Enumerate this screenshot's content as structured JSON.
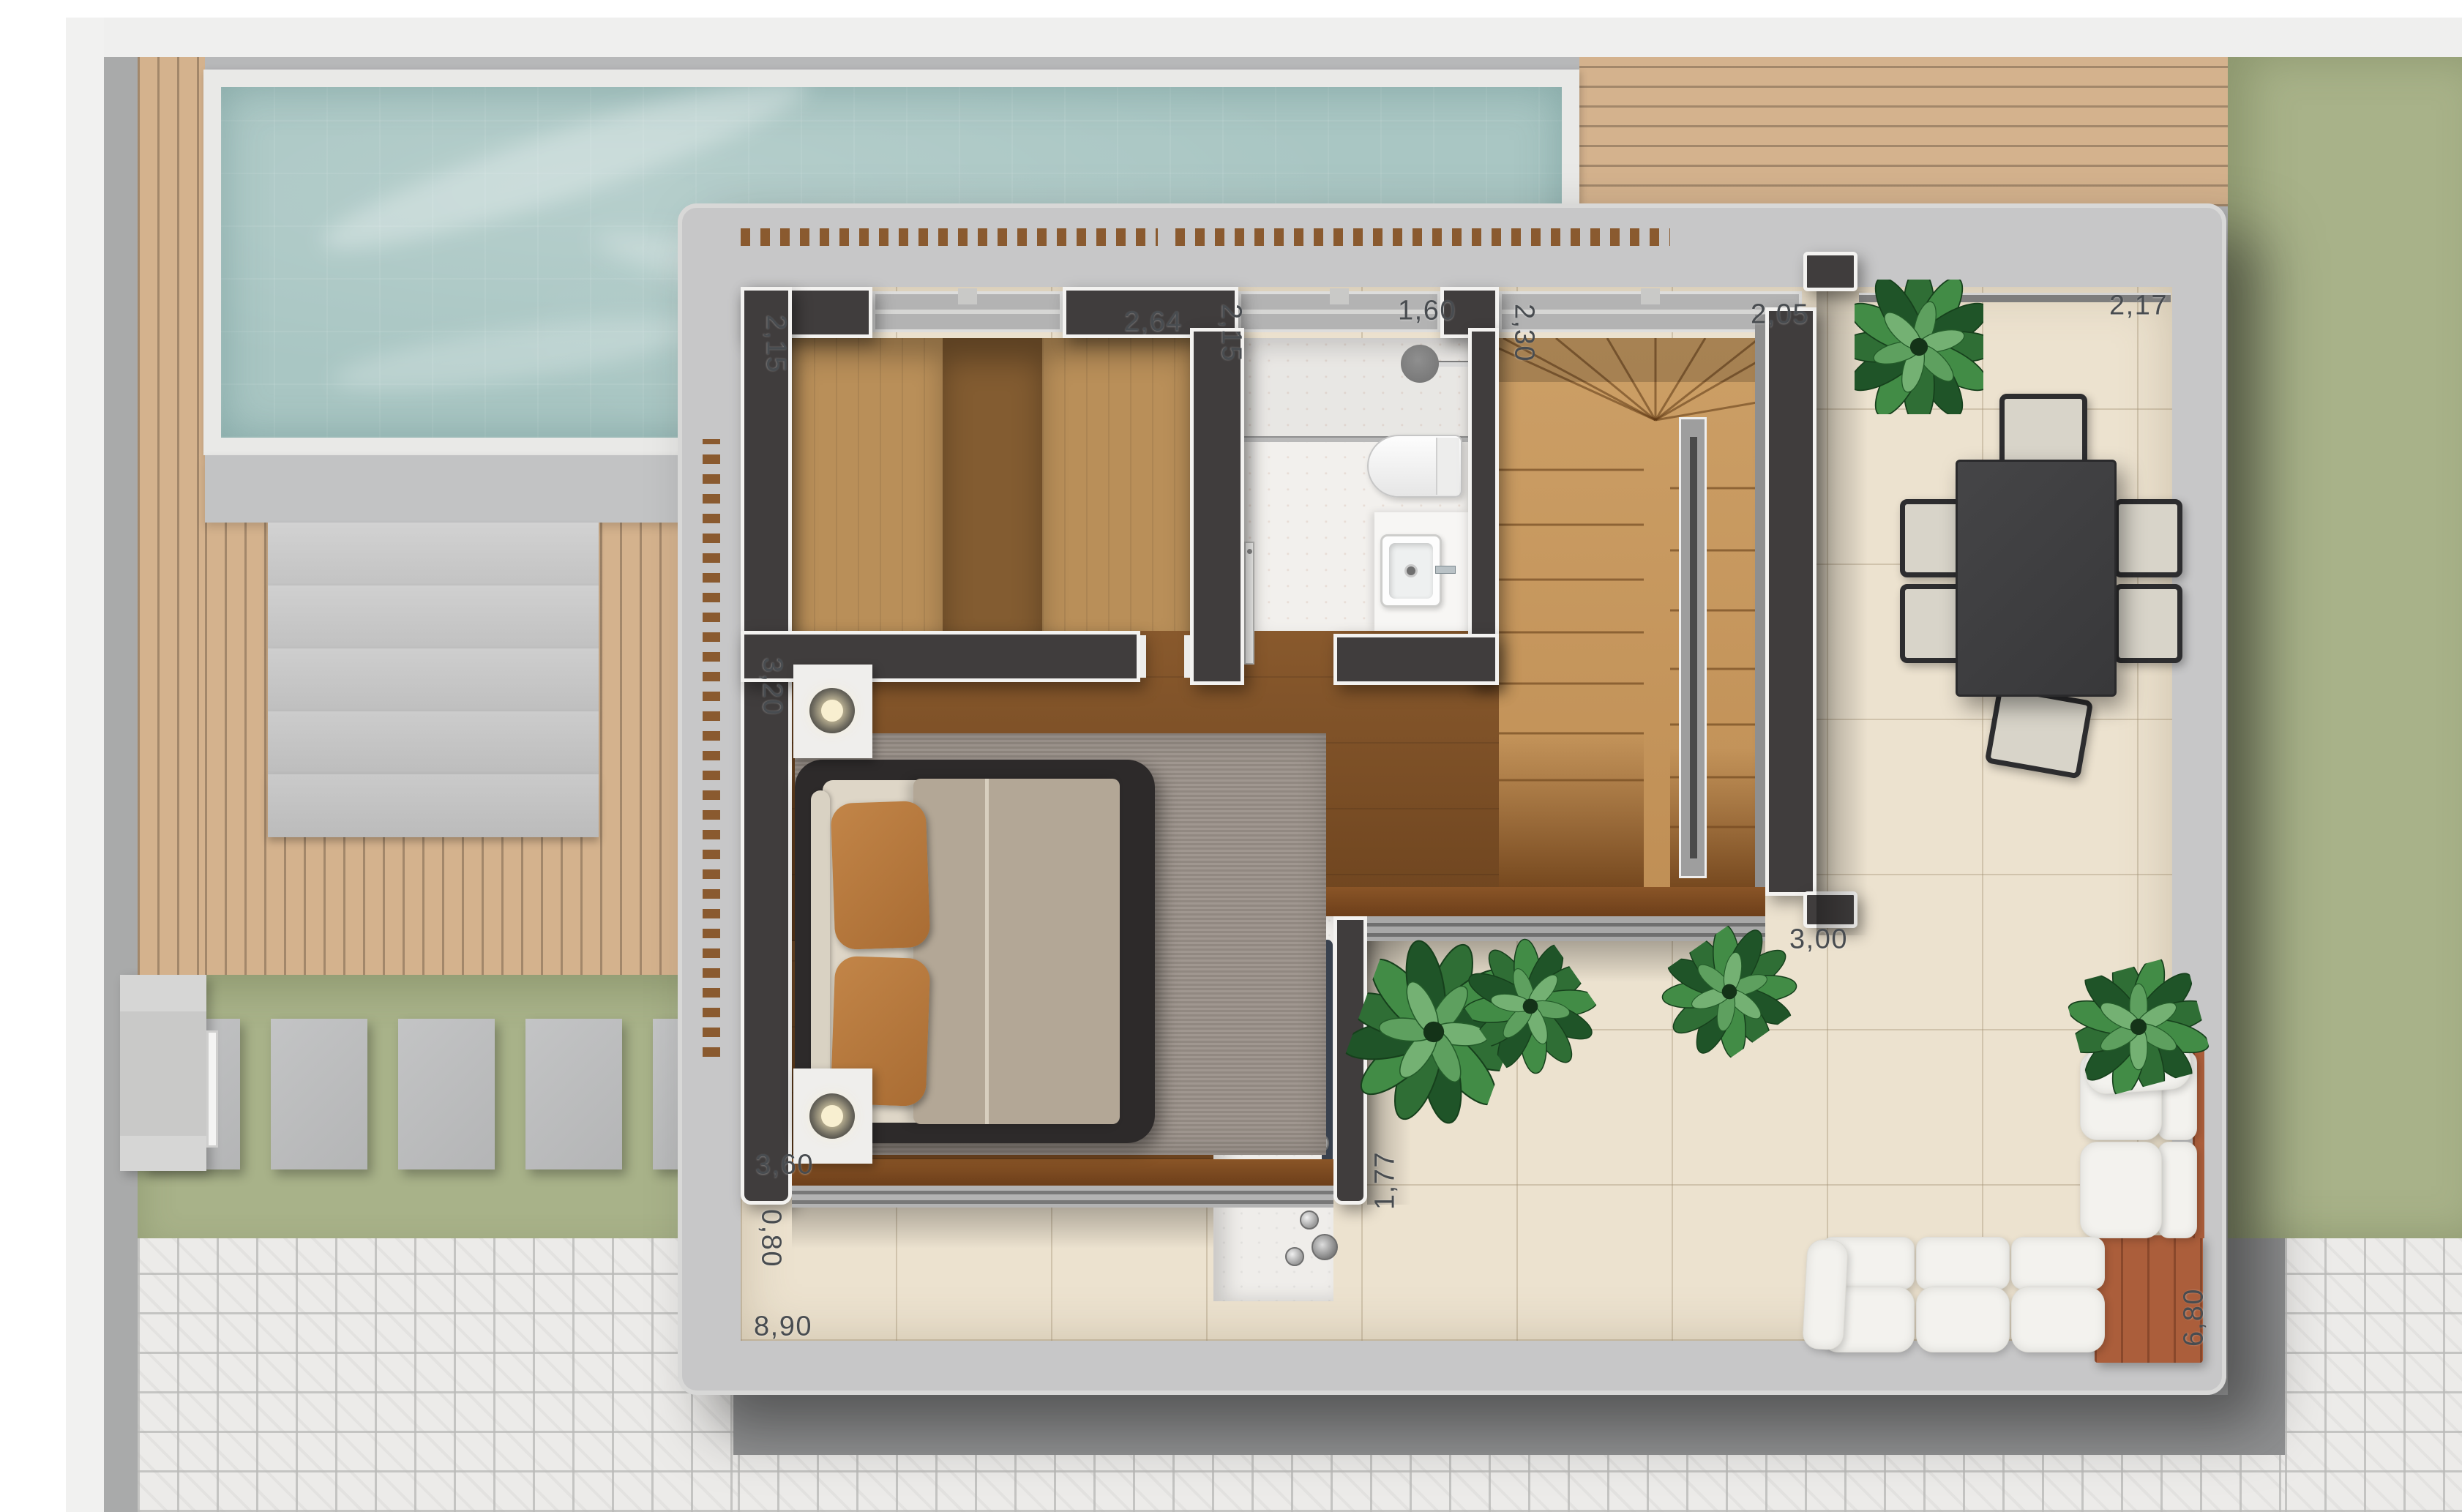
{
  "floorplan": {
    "dimensions": {
      "d215a": "2,15",
      "d264": "2,64",
      "d215b": "2,15",
      "d160": "1,60",
      "d230": "2,30",
      "d205": "2,05",
      "d217": "2,17",
      "d320": "3,20",
      "d300": "3,00",
      "d360": "3,60",
      "d177": "1,77",
      "d080": "0,80",
      "d890": "8,90",
      "d680": "6,80"
    },
    "colors": {
      "pool_water": "#a9c6c3",
      "lawn": "#a8b289",
      "terrace_tile": "#ece2cf",
      "wall": "#403d3d",
      "interior_wood": "#7b4c22",
      "deck_wood": "#d4b28d",
      "slab_concrete": "#c7c7c8",
      "sofa_wood": "#ab5e3b",
      "plant_green": "#2f6e35",
      "dimension_text": "#484c50"
    }
  }
}
